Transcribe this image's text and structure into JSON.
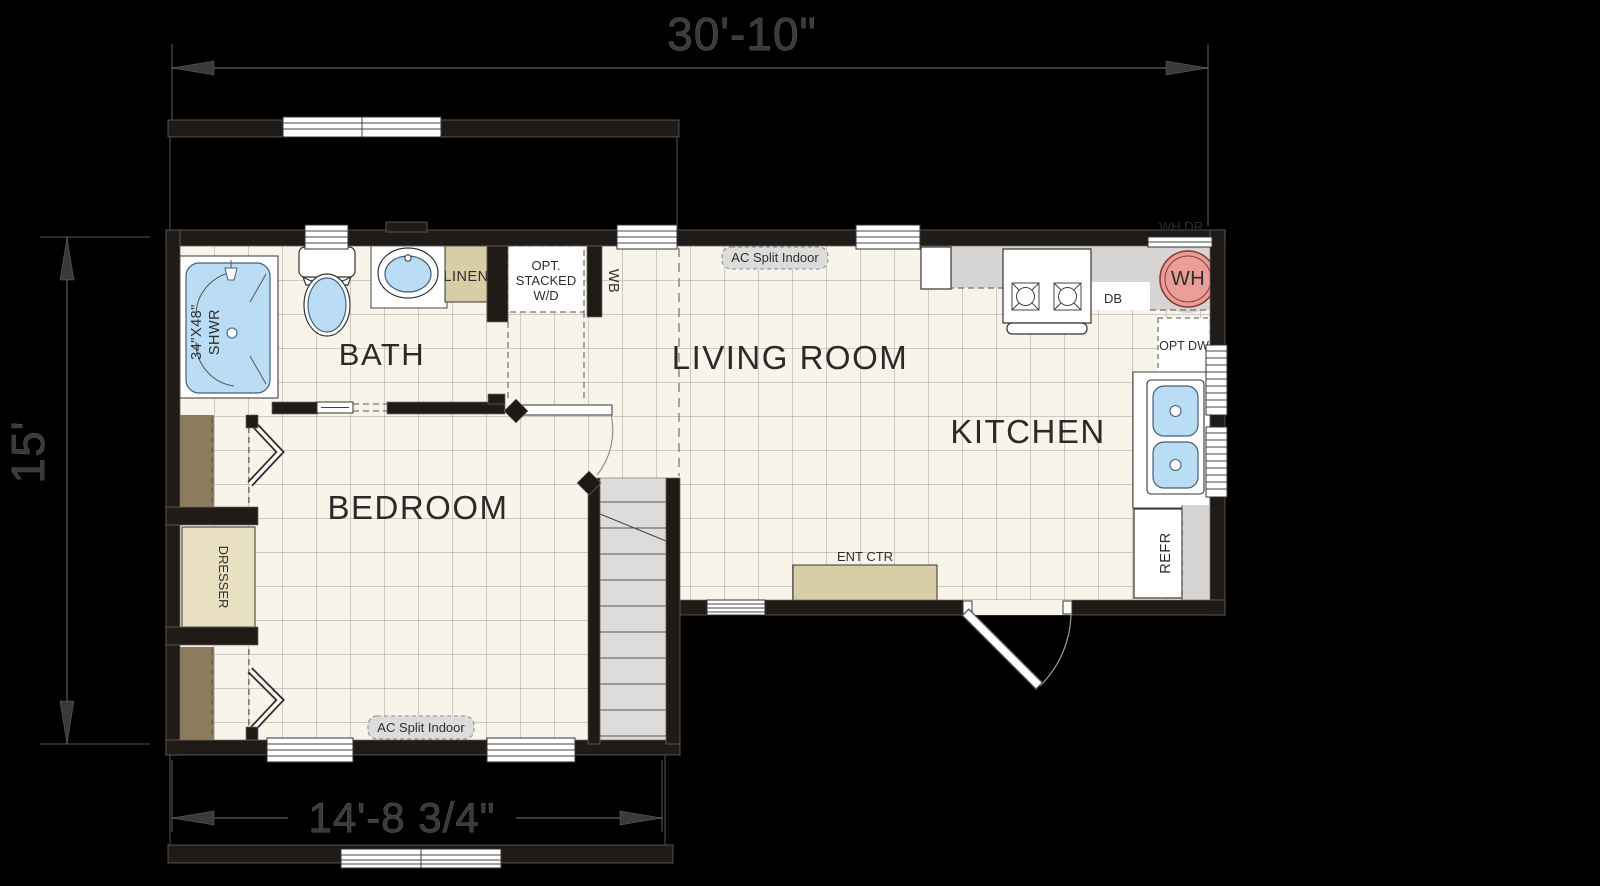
{
  "plan": {
    "title": "park-model-floor-plan",
    "dim_top": "30'-10\"",
    "dim_left": "15'",
    "dim_bottom": "14'-8 3/4\"",
    "rooms": {
      "bath": "BATH",
      "bedroom": "BEDROOM",
      "living": "LIVING ROOM",
      "kitchen": "KITCHEN"
    },
    "labels": {
      "linen": "LINEN",
      "wd_1": "OPT.",
      "wd_2": "STACKED",
      "wd_3": "W/D",
      "wb": "WB",
      "ac_split": "AC Split Indoor",
      "wh": "WH",
      "wh_dr": "WH DR",
      "db": "DB",
      "opt_dw": "OPT DW",
      "refr": "REFR",
      "ent_ctr": "ENT CTR",
      "dresser": "DRESSER",
      "shower_size": "34\"X48\"",
      "shower_name": "SHWR"
    },
    "colors": {
      "background": "#000000",
      "wall": "#201b17",
      "floor": "#f8f4ea",
      "floor_grid": "#a5a199",
      "fixture_blue": "#badcf4",
      "water_heater_red": "#eb9d97",
      "counter_gray": "#d6d5d3",
      "stair_gray": "#dedcdb",
      "furniture_tan": "#d8cda4",
      "dresser_tan": "#e9e0c2",
      "closet_brown": "#8d7b5e",
      "label_text": "#2a2a2a"
    }
  }
}
